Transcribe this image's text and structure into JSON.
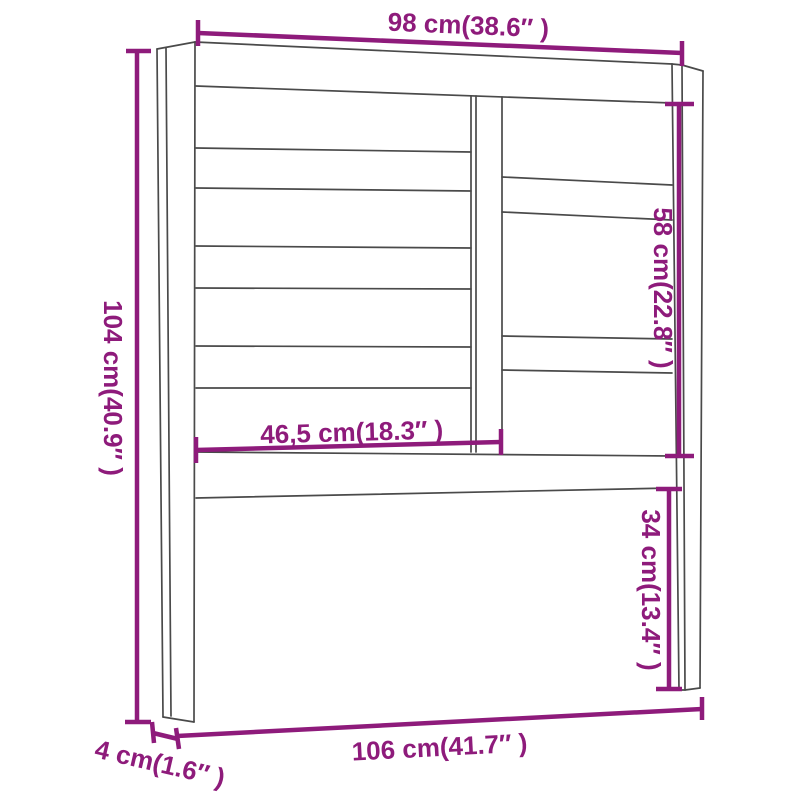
{
  "diagram": {
    "type": "product-dimension-diagram",
    "subject": "headboard",
    "colors": {
      "dimension_annotations": "#8E1B7B",
      "drawing_lines": "#4A4A4A",
      "background": "#FFFFFF"
    },
    "labels": {
      "width_top": "98 cm(38.6″ )",
      "height_left": "104 cm(40.9″ )",
      "inner_height_right": "58 cm(22.8″ )",
      "inner_width_middle": "46,5 cm(18.3″ )",
      "leg_height_right": "34 cm(13.4″ )",
      "width_bottom": "106 cm(41.7″ )",
      "depth_bottom_left": "4 cm(1.6″ )"
    },
    "measurements": [
      {
        "cm": "98",
        "inch": "38.6",
        "position": "top width"
      },
      {
        "cm": "104",
        "inch": "40.9",
        "position": "left overall height"
      },
      {
        "cm": "58",
        "inch": "22.8",
        "position": "right inner opening height"
      },
      {
        "cm": "46,5",
        "inch": "18.3",
        "position": "middle slat width"
      },
      {
        "cm": "34",
        "inch": "13.4",
        "position": "right leg height below panel"
      },
      {
        "cm": "106",
        "inch": "41.7",
        "position": "bottom overall width"
      },
      {
        "cm": "4",
        "inch": "1.6",
        "position": "post depth"
      }
    ]
  }
}
